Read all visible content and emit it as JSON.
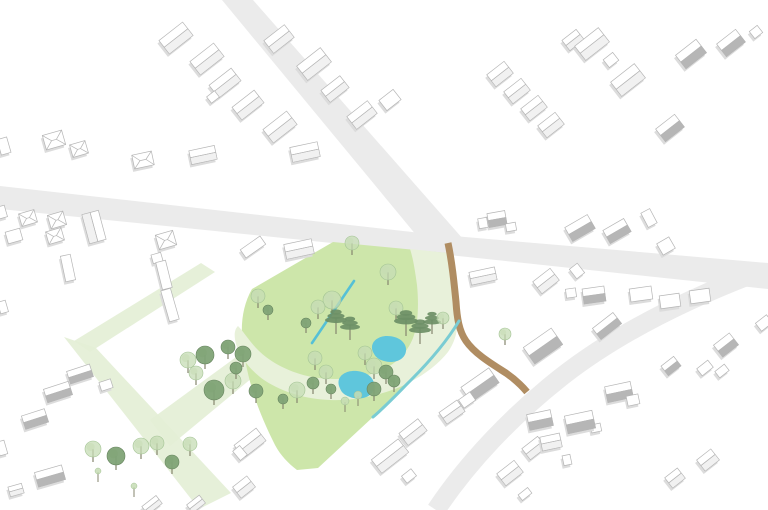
{
  "scene": {
    "width": 768,
    "height": 510,
    "background": "#ffffff",
    "description": "axonometric-site-plan"
  },
  "colors": {
    "road": "#ebebeb",
    "park_green": "#cde6aa",
    "pale_path": "#e8f1da",
    "pale_strip": "#e3eed5",
    "pond_blue": "#5fc6dc",
    "stream_blue": "#55c0d6",
    "teal_edge": "#7accd3",
    "brown_path": "#b08d62",
    "building_fill": "#ffffff",
    "building_stroke": "#b5b5b5",
    "building_shade": "#dcdcdc",
    "roof_dark": "#b6b6b6",
    "roof_light": "#f1f1f1",
    "tree_dark": "#7fa376",
    "tree_dark_stroke": "#66845e",
    "tree_light": "#c5dcb4",
    "tree_light_stroke": "#a3c394",
    "pine": "#6d8f66",
    "trunk": "#85856e"
  },
  "roads": {
    "quads": [
      [
        [
          222,
          0
        ],
        [
          253,
          0
        ],
        [
          463,
          239
        ],
        [
          431,
          253
        ]
      ],
      [
        [
          0,
          186
        ],
        [
          430,
          234
        ],
        [
          430,
          253
        ],
        [
          0,
          209
        ]
      ],
      [
        [
          430,
          234
        ],
        [
          768,
          263
        ],
        [
          768,
          289
        ],
        [
          430,
          253
        ]
      ]
    ],
    "curves": [
      {
        "d": "M 753,274 C 680,302 612,337 560,378 C 512,416 468,462 436,510",
        "width": 19
      }
    ]
  },
  "paths": {
    "brown": {
      "d": "M 448,243 C 452,262 454,282 456,302 C 457,318 459,331 466,341 C 475,354 492,364 506,373 C 516,380 522,386 527,392",
      "width": 7
    },
    "stream": {
      "d": "M 354,281 L 312,343",
      "width": 2.6
    },
    "teal_edge": {
      "d": "M 459,321 C 447,341 431,360 411,380 C 399,392 386,406 373,417",
      "width": 3
    }
  },
  "park": {
    "main": "M 333,242 L 447,253 C 452,274 455,294 459,317 L 459,321 C 447,341 431,360 411,380 C 399,392 386,406 373,417 L 318,468 L 297,470 C 288,463 281,456 275,445 C 267,429 259,411 254,395 C 248,377 244,357 242,337 C 241,319 244,303 252,289 Z",
    "pale_band": "M 410,249 L 447,253 C 452,274 454,294 457,314 C 459,329 455,342 448,352 C 437,366 420,378 400,387 C 378,396 352,401 330,400 C 305,399 282,392 264,380 C 250,370 240,357 236,344 C 234,336 234,330 238,326 C 244,332 249,341 258,350 C 271,363 291,373 312,377 C 335,381 360,379 380,371 C 396,364 407,353 413,338 C 418,325 419,305 417,285 C 415,270 413,258 410,249 Z",
    "strips": [
      [
        [
          201,
          263
        ],
        [
          215,
          272
        ],
        [
          90,
          352
        ],
        [
          74,
          341
        ]
      ],
      [
        [
          64,
          337
        ],
        [
          96,
          348
        ],
        [
          231,
          493
        ],
        [
          199,
          509
        ]
      ],
      [
        [
          150,
          420
        ],
        [
          243,
          352
        ],
        [
          258,
          373
        ],
        [
          170,
          446
        ]
      ]
    ]
  },
  "ponds": [
    "M 373,352 C 369,343 377,336 387,336 C 399,336 407,343 406,351 C 405,360 394,364 384,361 C 377,359 375,356 373,352 Z",
    "M 339,386 C 336,376 346,370 357,371 C 369,372 376,380 374,389 C 372,397 360,401 350,397 C 342,394 341,391 339,386 Z"
  ],
  "trees": [
    [
      352,
      243,
      7,
      "l"
    ],
    [
      388,
      272,
      8,
      "l"
    ],
    [
      396,
      308,
      7,
      "l"
    ],
    [
      332,
      300,
      9,
      "l"
    ],
    [
      318,
      307,
      7,
      "l"
    ],
    [
      306,
      323,
      5,
      "d"
    ],
    [
      258,
      296,
      7,
      "l"
    ],
    [
      268,
      310,
      5,
      "d"
    ],
    [
      336,
      320,
      11,
      "p"
    ],
    [
      350,
      327,
      10,
      "p"
    ],
    [
      406,
      321,
      12,
      "p"
    ],
    [
      420,
      330,
      11,
      "p"
    ],
    [
      432,
      322,
      9,
      "p"
    ],
    [
      443,
      318,
      6,
      "l"
    ],
    [
      205,
      355,
      9,
      "d"
    ],
    [
      228,
      347,
      7,
      "d"
    ],
    [
      243,
      354,
      8,
      "d"
    ],
    [
      188,
      360,
      8,
      "l"
    ],
    [
      196,
      373,
      7,
      "l"
    ],
    [
      214,
      390,
      10,
      "d"
    ],
    [
      233,
      381,
      8,
      "l"
    ],
    [
      236,
      368,
      6,
      "d"
    ],
    [
      256,
      391,
      7,
      "d"
    ],
    [
      297,
      390,
      8,
      "l"
    ],
    [
      283,
      399,
      5,
      "d"
    ],
    [
      313,
      383,
      6,
      "d"
    ],
    [
      315,
      358,
      7,
      "l"
    ],
    [
      326,
      372,
      7,
      "l"
    ],
    [
      331,
      389,
      5,
      "d"
    ],
    [
      365,
      353,
      7,
      "l"
    ],
    [
      374,
      366,
      8,
      "l"
    ],
    [
      386,
      372,
      7,
      "d"
    ],
    [
      374,
      389,
      7,
      "d"
    ],
    [
      394,
      381,
      6,
      "d"
    ],
    [
      358,
      398,
      4,
      "s"
    ],
    [
      345,
      404,
      4,
      "s"
    ],
    [
      505,
      334,
      6,
      "l"
    ],
    [
      93,
      449,
      8,
      "l"
    ],
    [
      116,
      456,
      9,
      "d"
    ],
    [
      141,
      446,
      8,
      "l"
    ],
    [
      157,
      443,
      7,
      "l"
    ],
    [
      172,
      462,
      7,
      "d"
    ],
    [
      190,
      444,
      7,
      "l"
    ],
    [
      98,
      474,
      3,
      "s"
    ],
    [
      134,
      489,
      3,
      "s"
    ]
  ],
  "buildings": [
    [
      176,
      38,
      30,
      17,
      -38,
      "g"
    ],
    [
      207,
      59,
      30,
      17,
      -38,
      "g"
    ],
    [
      225,
      83,
      28,
      16,
      -38,
      "g"
    ],
    [
      248,
      105,
      28,
      16,
      -38,
      "g"
    ],
    [
      280,
      127,
      30,
      17,
      -38,
      "g"
    ],
    [
      213,
      97,
      10,
      8,
      -38,
      "b"
    ],
    [
      279,
      39,
      26,
      16,
      -38,
      "g"
    ],
    [
      314,
      64,
      30,
      18,
      -38,
      "g"
    ],
    [
      335,
      89,
      24,
      15,
      -38,
      "g"
    ],
    [
      362,
      115,
      26,
      16,
      -38,
      "g"
    ],
    [
      390,
      100,
      18,
      13,
      -38,
      "b"
    ],
    [
      54,
      140,
      20,
      15,
      -16,
      "h"
    ],
    [
      79,
      149,
      16,
      13,
      -16,
      "h"
    ],
    [
      143,
      160,
      20,
      14,
      -12,
      "h"
    ],
    [
      4,
      146,
      10,
      16,
      -16,
      "b"
    ],
    [
      2,
      212,
      8,
      12,
      -16,
      "b"
    ],
    [
      3,
      307,
      8,
      12,
      -16,
      "b"
    ],
    [
      203,
      155,
      26,
      14,
      -12,
      "g"
    ],
    [
      305,
      152,
      28,
      15,
      -12,
      "g"
    ],
    [
      500,
      74,
      22,
      15,
      -38,
      "g"
    ],
    [
      517,
      91,
      22,
      15,
      -38,
      "g"
    ],
    [
      534,
      108,
      22,
      15,
      -38,
      "g"
    ],
    [
      551,
      125,
      22,
      15,
      -38,
      "g"
    ],
    [
      573,
      40,
      18,
      13,
      -38,
      "g"
    ],
    [
      592,
      44,
      30,
      18,
      -38,
      "g"
    ],
    [
      628,
      80,
      30,
      18,
      -38,
      "g"
    ],
    [
      611,
      60,
      12,
      10,
      -38,
      "b"
    ],
    [
      691,
      54,
      26,
      17,
      -38,
      "gd"
    ],
    [
      731,
      43,
      24,
      16,
      -38,
      "gd"
    ],
    [
      756,
      32,
      10,
      9,
      -38,
      "b"
    ],
    [
      670,
      128,
      24,
      16,
      -38,
      "gd"
    ],
    [
      580,
      228,
      26,
      16,
      -30,
      "gd"
    ],
    [
      617,
      231,
      24,
      15,
      -30,
      "gd"
    ],
    [
      649,
      218,
      16,
      10,
      62,
      "b"
    ],
    [
      666,
      246,
      14,
      13,
      -30,
      "b"
    ],
    [
      497,
      219,
      18,
      14,
      -10,
      "gd"
    ],
    [
      483,
      223,
      9,
      10,
      -10,
      "b"
    ],
    [
      511,
      227,
      10,
      8,
      -10,
      "b"
    ],
    [
      594,
      295,
      22,
      15,
      -8,
      "gd"
    ],
    [
      571,
      293,
      10,
      9,
      -8,
      "b"
    ],
    [
      641,
      294,
      22,
      13,
      -8,
      "b"
    ],
    [
      670,
      301,
      20,
      13,
      -8,
      "b"
    ],
    [
      700,
      296,
      20,
      13,
      -8,
      "b"
    ],
    [
      607,
      326,
      26,
      14,
      -38,
      "gd"
    ],
    [
      726,
      345,
      20,
      15,
      -38,
      "gd"
    ],
    [
      671,
      366,
      16,
      12,
      -38,
      "gd"
    ],
    [
      705,
      368,
      14,
      9,
      -38,
      "b"
    ],
    [
      722,
      371,
      12,
      8,
      -38,
      "b"
    ],
    [
      764,
      323,
      14,
      10,
      -38,
      "b"
    ],
    [
      483,
      276,
      26,
      13,
      -12,
      "g"
    ],
    [
      546,
      281,
      22,
      15,
      -38,
      "g"
    ],
    [
      577,
      271,
      10,
      12,
      -38,
      "b"
    ],
    [
      543,
      346,
      34,
      20,
      -35,
      "gd"
    ],
    [
      480,
      385,
      34,
      18,
      -35,
      "gd"
    ],
    [
      467,
      400,
      14,
      10,
      -35,
      "b"
    ],
    [
      452,
      412,
      22,
      14,
      -35,
      "g"
    ],
    [
      413,
      432,
      24,
      15,
      -38,
      "g"
    ],
    [
      390,
      456,
      34,
      17,
      -38,
      "g"
    ],
    [
      409,
      476,
      12,
      9,
      -38,
      "b"
    ],
    [
      540,
      420,
      24,
      16,
      -12,
      "gd"
    ],
    [
      596,
      428,
      10,
      8,
      -12,
      "b"
    ],
    [
      534,
      448,
      20,
      14,
      -38,
      "g"
    ],
    [
      510,
      473,
      22,
      15,
      -38,
      "g"
    ],
    [
      525,
      494,
      12,
      7,
      -38,
      "b"
    ],
    [
      619,
      392,
      26,
      16,
      -12,
      "gd"
    ],
    [
      633,
      400,
      12,
      10,
      -12,
      "b"
    ],
    [
      580,
      422,
      28,
      18,
      -12,
      "gd"
    ],
    [
      551,
      442,
      20,
      14,
      -12,
      "g"
    ],
    [
      567,
      460,
      8,
      10,
      -12,
      "b"
    ],
    [
      708,
      460,
      18,
      14,
      -38,
      "g"
    ],
    [
      675,
      478,
      16,
      13,
      -38,
      "g"
    ],
    [
      28,
      218,
      16,
      13,
      -16,
      "h"
    ],
    [
      57,
      220,
      16,
      14,
      -16,
      "h"
    ],
    [
      14,
      236,
      15,
      12,
      -16,
      "b"
    ],
    [
      55,
      236,
      16,
      13,
      -16,
      "h"
    ],
    [
      94,
      227,
      30,
      17,
      75,
      "g"
    ],
    [
      68,
      268,
      26,
      10,
      78,
      "b"
    ],
    [
      166,
      240,
      18,
      15,
      -16,
      "h"
    ],
    [
      157,
      258,
      10,
      9,
      -16,
      "b"
    ],
    [
      164,
      275,
      28,
      10,
      76,
      "b"
    ],
    [
      170,
      305,
      32,
      10,
      74,
      "b"
    ],
    [
      253,
      247,
      24,
      10,
      -35,
      "b"
    ],
    [
      299,
      249,
      28,
      15,
      -12,
      "g"
    ],
    [
      80,
      374,
      24,
      13,
      -18,
      "gd"
    ],
    [
      58,
      392,
      26,
      14,
      -18,
      "gd"
    ],
    [
      106,
      385,
      12,
      9,
      -18,
      "b"
    ],
    [
      35,
      419,
      24,
      14,
      -18,
      "gd"
    ],
    [
      50,
      476,
      28,
      15,
      -16,
      "gd"
    ],
    [
      16,
      490,
      14,
      10,
      -16,
      "g"
    ],
    [
      2,
      448,
      8,
      14,
      -16,
      "b"
    ],
    [
      250,
      443,
      28,
      16,
      -38,
      "g"
    ],
    [
      240,
      453,
      12,
      9,
      50,
      "b"
    ],
    [
      244,
      487,
      18,
      14,
      -38,
      "g"
    ],
    [
      152,
      505,
      18,
      10,
      -38,
      "g"
    ],
    [
      196,
      504,
      16,
      10,
      -38,
      "g"
    ]
  ]
}
